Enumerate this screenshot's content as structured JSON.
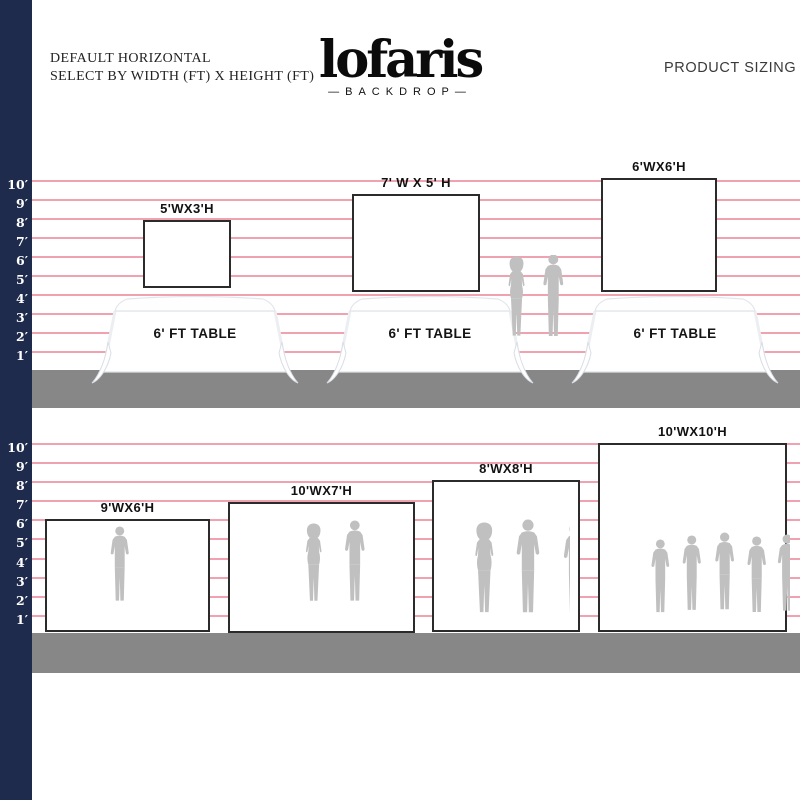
{
  "header": {
    "subtitle_line1": "DEFAULT HORIZONTAL",
    "subtitle_line2": "SELECT BY WIDTH (FT) X HEIGHT (FT)",
    "logo_text": "lofaris",
    "logo_left_dash": "—",
    "logo_subtext": "BACKDROP",
    "logo_right_dash": "—",
    "product_sizing_label": "PRODUCT SIZING"
  },
  "ruler": {
    "labels": [
      "10′",
      "9′",
      "8′",
      "7′",
      "6′",
      "5′",
      "4′",
      "3′",
      "2′",
      "1′"
    ]
  },
  "colors": {
    "navy_bar": "#1f2b4d",
    "grid_line": "#f0a2b1",
    "floor": "#878787",
    "silhouette": "#c0c0c1",
    "backdrop_border": "#2b2b2b"
  },
  "top_section": {
    "table_label": "6' FT TABLE",
    "backdrops": [
      {
        "label": "5'WX3'H",
        "width_ft": 5,
        "height_ft": 3
      },
      {
        "label": "7' W X 5' H",
        "width_ft": 7,
        "height_ft": 5
      },
      {
        "label": "6'WX6'H",
        "width_ft": 6,
        "height_ft": 6
      }
    ]
  },
  "bottom_section": {
    "backdrops": [
      {
        "label": "9'WX6'H",
        "width_ft": 9,
        "height_ft": 6
      },
      {
        "label": "10'WX7'H",
        "width_ft": 10,
        "height_ft": 7
      },
      {
        "label": "8'WX8'H",
        "width_ft": 8,
        "height_ft": 8
      },
      {
        "label": "10'WX10'H",
        "width_ft": 10,
        "height_ft": 10
      }
    ]
  }
}
